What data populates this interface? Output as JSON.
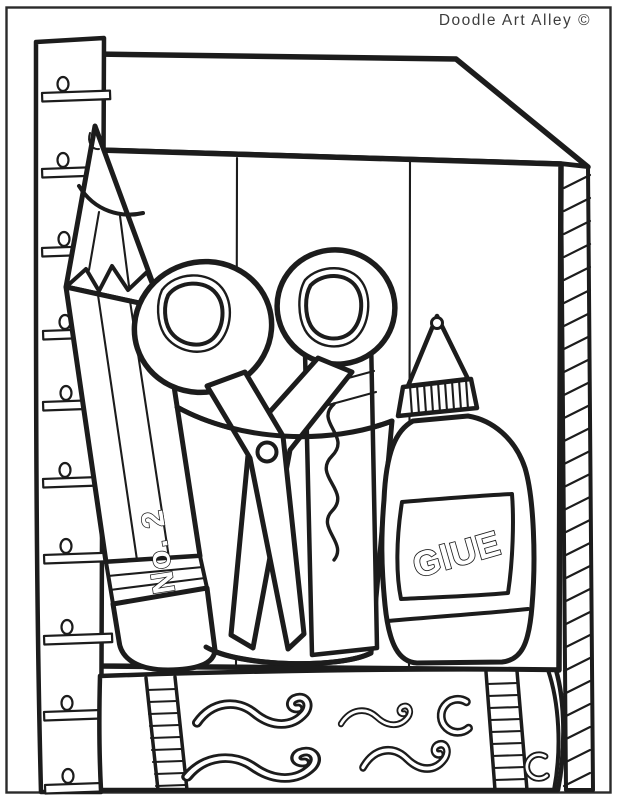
{
  "page": {
    "title": "Doodle Art Alley ©",
    "background": "#ffffff",
    "ink_color": "#1c1c1c"
  },
  "artwork": {
    "type": "coloring-page line art",
    "subject": "school supplies: ruler, pencil, scissors and marker in a cup, glue bottle, pencil case in front of a supply box",
    "labels": {
      "pencil": "No. 2",
      "glue": "GlUE"
    },
    "objects": [
      "supply-box",
      "ruler",
      "pencil",
      "scissors",
      "pen-cup",
      "marker",
      "glue-bottle",
      "pencil-case"
    ]
  }
}
